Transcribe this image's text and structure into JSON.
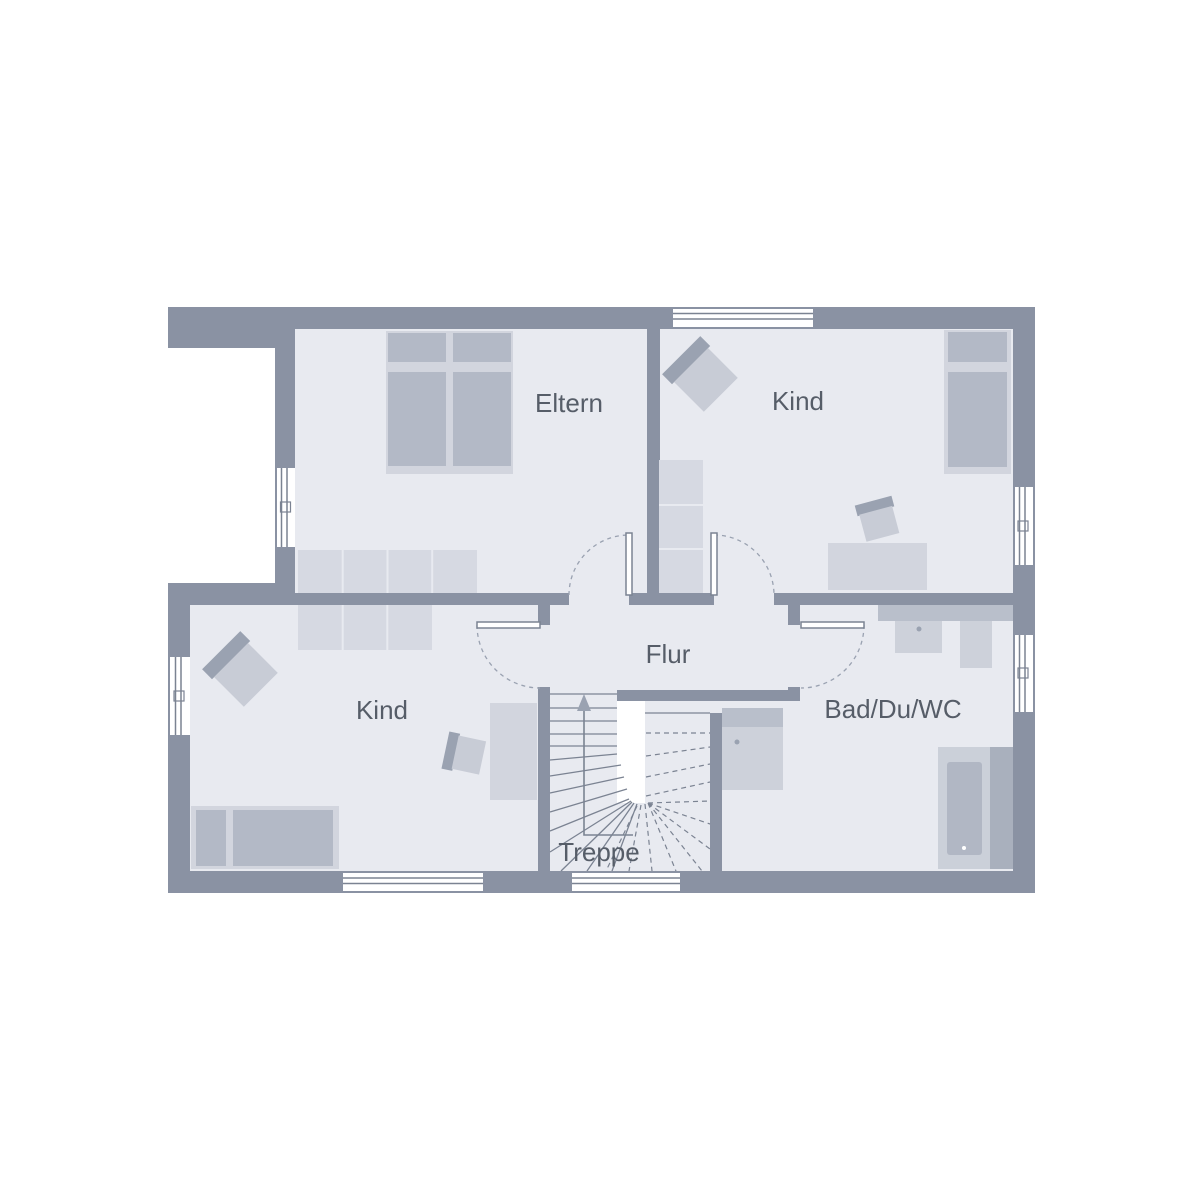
{
  "plan": {
    "type": "floor-plan",
    "rooms": [
      {
        "id": "eltern",
        "label": "Eltern"
      },
      {
        "id": "kind-top",
        "label": "Kind"
      },
      {
        "id": "kind-bottom",
        "label": "Kind"
      },
      {
        "id": "flur",
        "label": "Flur"
      },
      {
        "id": "bad",
        "label": "Bad/Du/WC"
      },
      {
        "id": "treppe",
        "label": "Treppe"
      }
    ]
  },
  "colors": {
    "wall": "#8a92a3",
    "floor": "#e8eaf0",
    "furn-light": "#d2d5de",
    "furn-med": "#b3b9c6",
    "wardrobe": "#d6d9e2",
    "armchair": "#c8ccd6",
    "accent-dark": "#9aa2b1",
    "fixture": "#cdd1da",
    "counter": "#b9bfcb",
    "tub": "#b1b7c4",
    "tub-platform": "#cbd0d9",
    "tub-side": "#a9b0bd",
    "line": "#7b8392",
    "text": "#565d68"
  }
}
